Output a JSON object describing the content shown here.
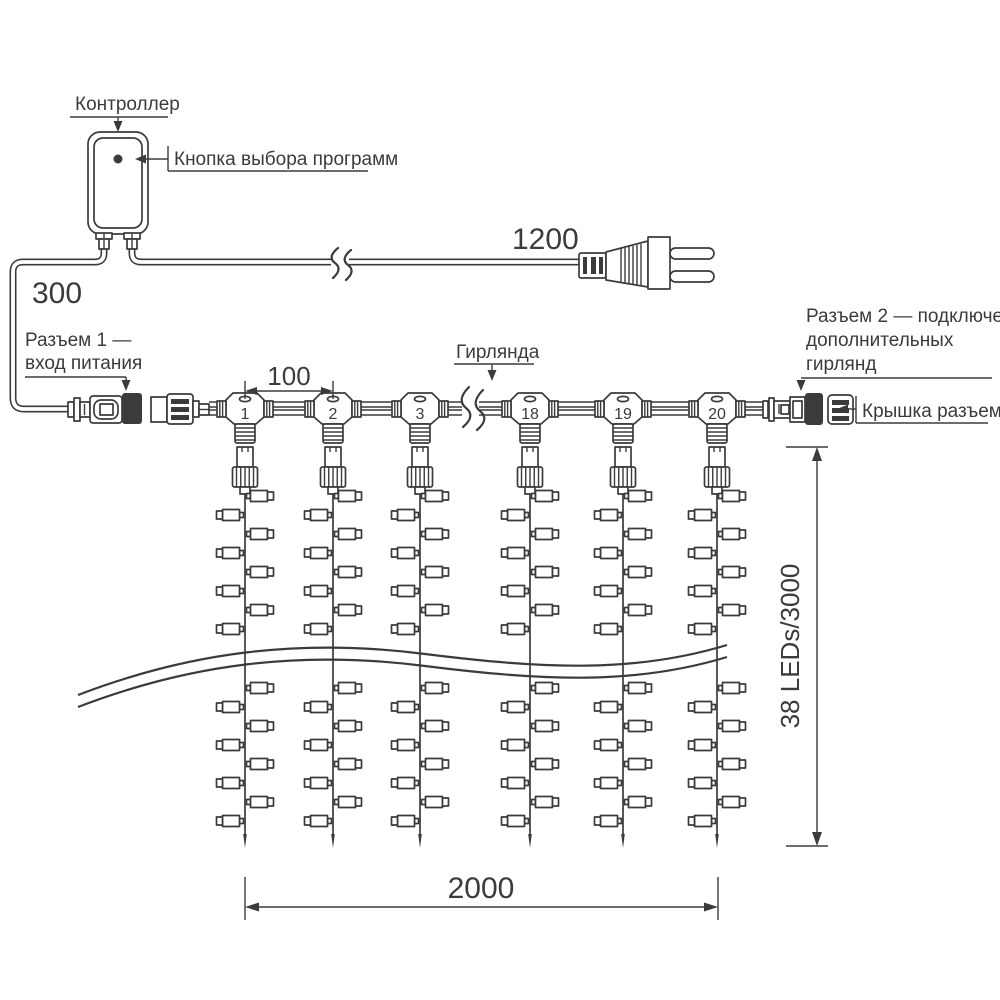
{
  "diagram": {
    "controller": {
      "label": "Контроллер",
      "button_label": "Кнопка выбора программ"
    },
    "connector1": {
      "label_line1": "Разъем 1 —",
      "label_line2": "вход питания"
    },
    "connector2": {
      "label_line1": "Разъем 2 — подключение",
      "label_line2": "дополнительных",
      "label_line3": "гирлянд"
    },
    "cap_label": "Крышка разъема",
    "garland_label": "Гирлянда",
    "dimensions": {
      "lead_in": "300",
      "power_cord": "1200",
      "drop_spacing": "100",
      "curtain_width": "2000",
      "string_spec": "38 LEDs/3000"
    },
    "drops": [
      {
        "number": "1"
      },
      {
        "number": "2"
      },
      {
        "number": "3"
      },
      {
        "number": "18"
      },
      {
        "number": "19"
      },
      {
        "number": "20"
      }
    ],
    "colors": {
      "stroke": "#3b3b3b",
      "background": "#ffffff"
    }
  }
}
